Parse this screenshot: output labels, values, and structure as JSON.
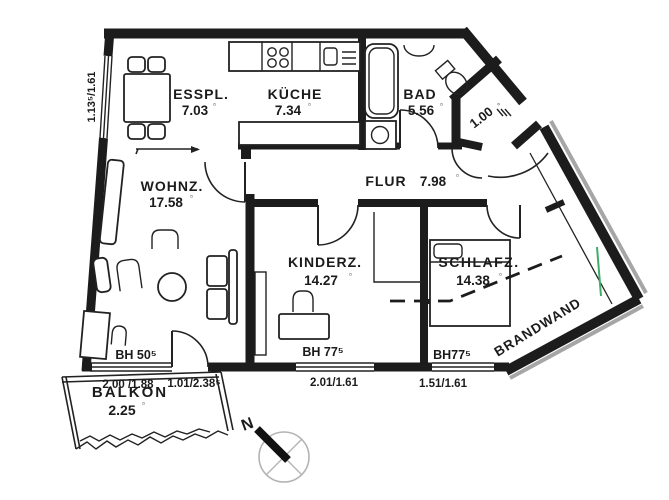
{
  "floor_plan": {
    "rooms": {
      "esspl": {
        "name": "ESSPL.",
        "area": "7.03"
      },
      "kueche": {
        "name": "KÜCHE",
        "area": "7.34"
      },
      "bad": {
        "name": "BAD",
        "area": "5.56"
      },
      "garderobe": {
        "area": "1.00"
      },
      "flur": {
        "name": "FLUR",
        "area": "7.98"
      },
      "wohnz": {
        "name": "WOHNZ.",
        "area": "17.58"
      },
      "kinderz": {
        "name": "KINDERZ.",
        "area": "14.27"
      },
      "schlafz": {
        "name": "SCHLAFZ.",
        "area": "14.38"
      },
      "balkon": {
        "name": "BALKON",
        "area": "2.25"
      }
    },
    "area_unit_symbol": "▫",
    "sill_heights": {
      "wohnz_window": "BH 50⁵",
      "kinderz_window": "BH 77⁵",
      "schlafz_window": "BH77⁵"
    },
    "dimensions": {
      "esspl_window": "1.13⁵/1.61",
      "wohnz_window": "2.00 /1.88",
      "balkon_door": "1.01/2.38⁵",
      "kinderz_window": "2.01/1.61",
      "schlafz_window": "1.51/1.61"
    },
    "annotations": {
      "firewall": "BRANDWAND",
      "compass_north": "N"
    }
  }
}
